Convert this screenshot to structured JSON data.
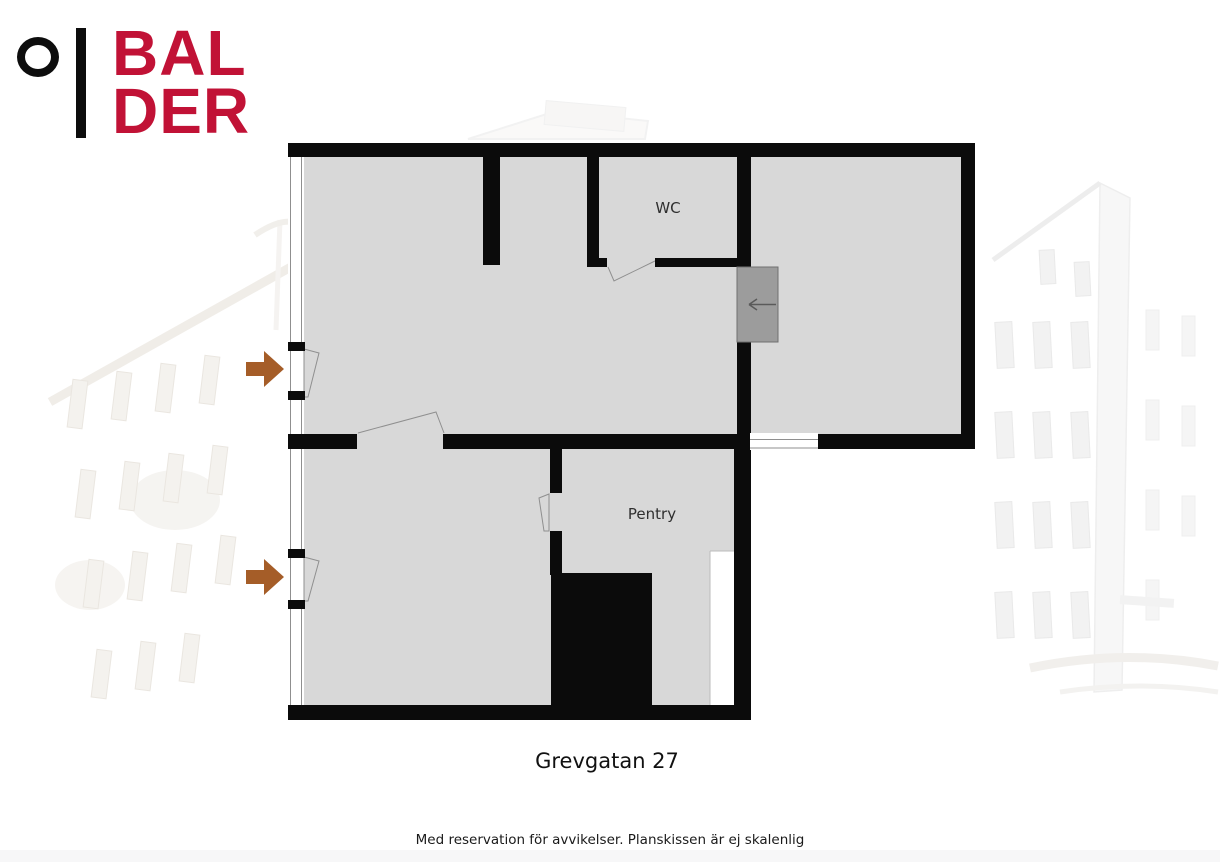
{
  "brand": {
    "line1": "BAL",
    "line2": "DER",
    "circle_icon": "circle-outline-icon"
  },
  "plan": {
    "address": "Grevgatan 27",
    "disclaimer": "Med reservation för avvikelser. Planskissen är ej skalenlig",
    "rooms": [
      {
        "name": "wc",
        "label": "WC"
      },
      {
        "name": "pentry",
        "label": "Pentry"
      }
    ],
    "entrance_arrows": [
      {
        "name": "upper-entrance-arrow",
        "direction": "right"
      },
      {
        "name": "lower-entrance-arrow",
        "direction": "right"
      }
    ],
    "lift": {
      "direction_arrow": "left"
    }
  },
  "colors": {
    "brand_red": "#c11236",
    "logo_black": "#0d0d0d",
    "wall_black": "#0b0b0b",
    "floor_gray": "#d8d8d8",
    "lift_gray": "#9c9c9c",
    "lift_border": "#707070",
    "lift_arrow": "#5a5a5a",
    "arrow_brown": "#a55d28",
    "line_gray": "#8f8f8f",
    "label_color": "#2f2f2f",
    "title_color": "#111111",
    "disclaimer_color": "#1a1a1a",
    "strip_gray": "#f7f7f8"
  }
}
